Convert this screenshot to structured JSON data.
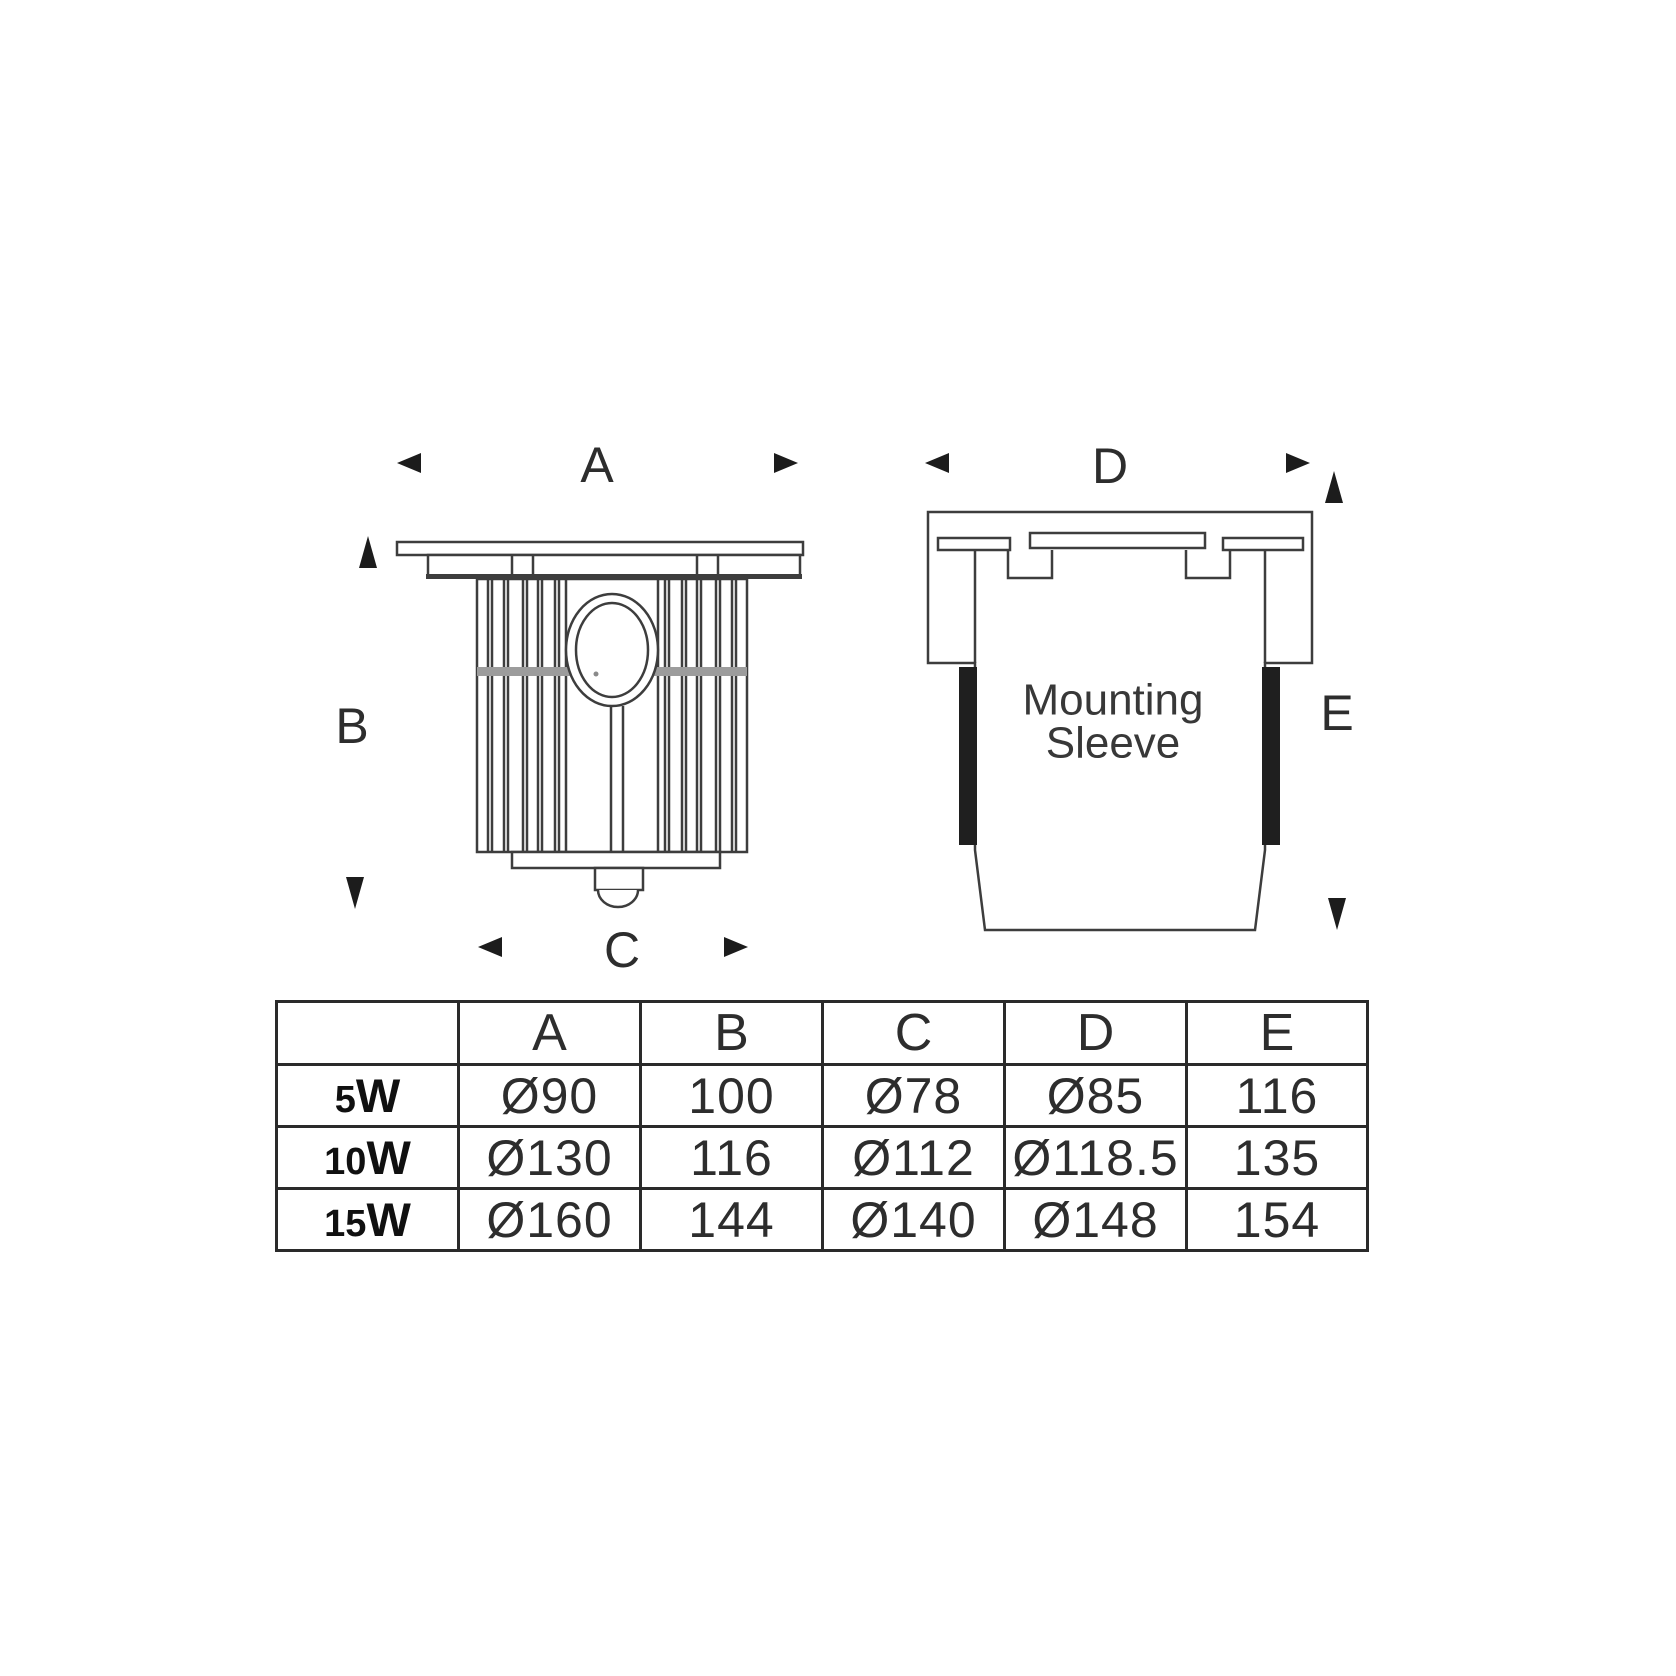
{
  "diagram": {
    "labels": {
      "a": "A",
      "b": "B",
      "c": "C",
      "d": "D",
      "e": "E"
    },
    "mounting_sleeve": {
      "line1": "Mounting",
      "line2": "Sleeve"
    }
  },
  "table": {
    "columns": [
      "A",
      "B",
      "C",
      "D",
      "E"
    ],
    "rows": [
      {
        "power": "5",
        "unit": "W",
        "values": [
          "Ø90",
          "100",
          "Ø78",
          "Ø85",
          "116"
        ]
      },
      {
        "power": "10",
        "unit": "W",
        "values": [
          "Ø130",
          "116",
          "Ø112",
          "Ø118.5",
          "135"
        ]
      },
      {
        "power": "15",
        "unit": "W",
        "values": [
          "Ø160",
          "144",
          "Ø140",
          "Ø148",
          "154"
        ]
      }
    ]
  },
  "colors": {
    "ink": "#3d3d3d",
    "text": "#2d2d2d",
    "band_gray": "#9c9c9c",
    "gasket_black": "#1f1f1f",
    "table_border": "#2a2a2a"
  }
}
